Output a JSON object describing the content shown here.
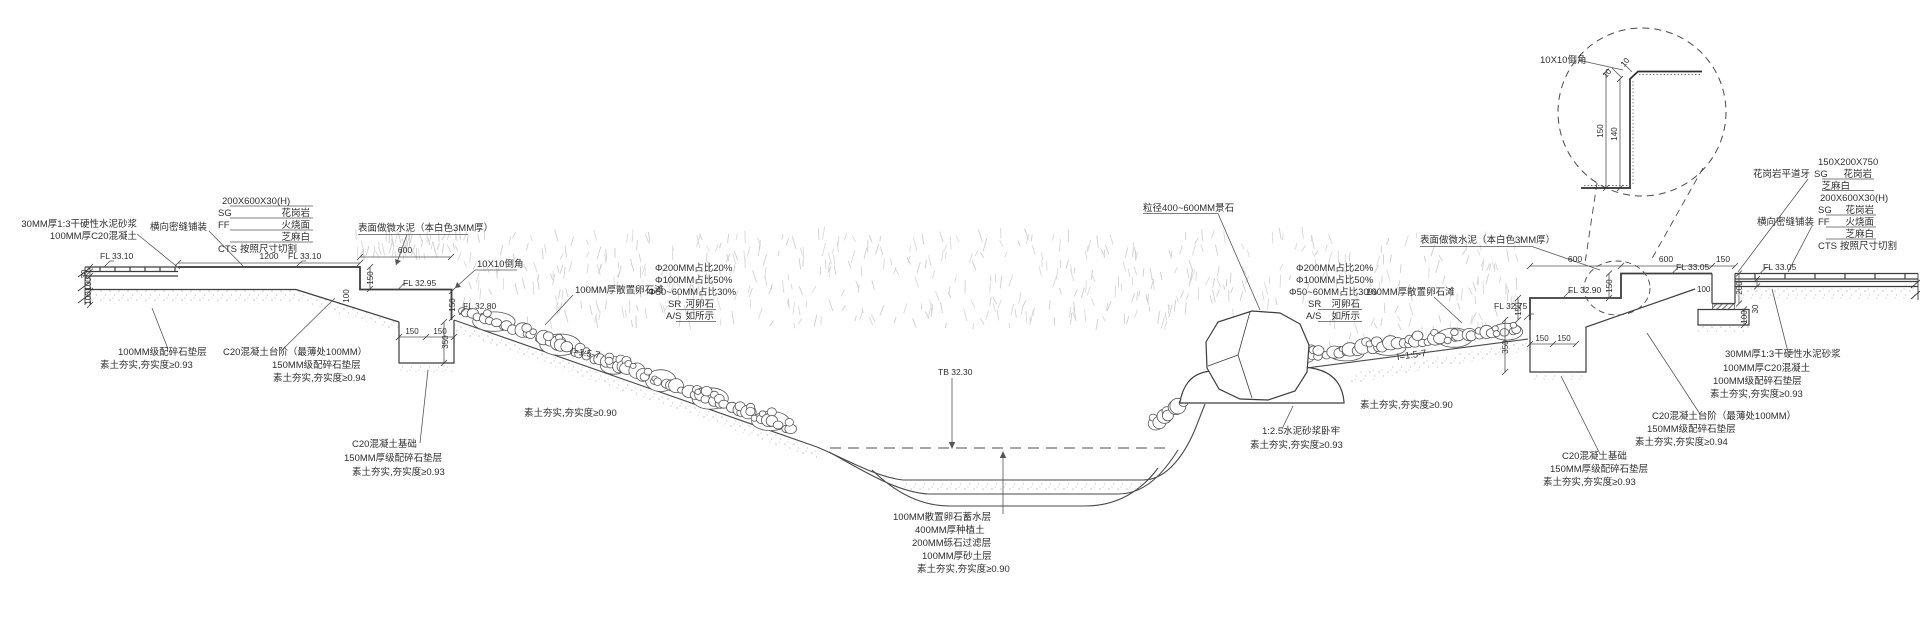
{
  "drawing": {
    "type": "landscape-dry-creek-section-detail",
    "colors": {
      "line": "#3d3d3d",
      "thin_line": "#555555",
      "text": "#2e2e2e",
      "grass": "#d8d8d8",
      "speckle": "#c2c2c2",
      "water_dash": "#a6a6a6"
    }
  },
  "annotations": [
    {
      "t": "30MM厚1:3干硬性水泥砂浆",
      "x": 137,
      "y": 227,
      "a": "e"
    },
    {
      "t": "100MM厚C20混凝土",
      "x": 137,
      "y": 239,
      "a": "e"
    },
    {
      "t": "横向密缝铺装",
      "x": 207,
      "y": 230,
      "a": "e"
    },
    {
      "t": "200X600X30(H)",
      "x": 222,
      "y": 204
    },
    {
      "t": "SG",
      "x": 218,
      "y": 216
    },
    {
      "t": "花岗岩",
      "x": 310,
      "y": 216,
      "a": "e"
    },
    {
      "t": "FF",
      "x": 218,
      "y": 228
    },
    {
      "t": "火烧面",
      "x": 310,
      "y": 228,
      "a": "e"
    },
    {
      "t": "芝麻白",
      "x": 310,
      "y": 240,
      "a": "e"
    },
    {
      "t": "CTS",
      "x": 218,
      "y": 252
    },
    {
      "t": "按照尺寸切割",
      "x": 240,
      "y": 252
    },
    {
      "t": "FL 33.10",
      "x": 100,
      "y": 259,
      "s": 8.5
    },
    {
      "t": "1200",
      "x": 269,
      "y": 259,
      "a": "m",
      "s": 8.5
    },
    {
      "t": "FL 33.10",
      "x": 288,
      "y": 259,
      "s": 8.5
    },
    {
      "t": "30",
      "x": 87,
      "y": 274,
      "r": -90,
      "a": "m",
      "s": 8
    },
    {
      "t": "100",
      "x": 91,
      "y": 284,
      "r": -90,
      "a": "m",
      "s": 8
    },
    {
      "t": "100",
      "x": 91,
      "y": 298,
      "r": -90,
      "a": "m",
      "s": 8
    },
    {
      "t": "100MM级配碎石垫层",
      "x": 118,
      "y": 355
    },
    {
      "t": "素土夯实,夯实度≥0.93",
      "x": 100,
      "y": 368
    },
    {
      "t": "C20混凝土台阶（最薄处100MM）",
      "x": 223,
      "y": 355
    },
    {
      "t": "150MM级配碎石垫层",
      "x": 272,
      "y": 368
    },
    {
      "t": "素土夯实,夯实度≥0.94",
      "x": 273,
      "y": 381
    },
    {
      "t": "表面做微水泥（本白色3MM厚）",
      "x": 358,
      "y": 231
    },
    {
      "t": "600",
      "x": 405,
      "y": 253,
      "a": "m",
      "s": 8.5
    },
    {
      "t": "FL 32.95",
      "x": 403,
      "y": 286,
      "s": 8.5
    },
    {
      "t": "150",
      "x": 373,
      "y": 278,
      "r": -90,
      "a": "m",
      "s": 8
    },
    {
      "t": "100",
      "x": 349,
      "y": 296,
      "r": -90,
      "a": "m",
      "s": 8
    },
    {
      "t": "10X10倒角",
      "x": 477,
      "y": 267
    },
    {
      "t": "150",
      "x": 455,
      "y": 305,
      "r": -90,
      "a": "m",
      "s": 8
    },
    {
      "t": "FL 32.80",
      "x": 463,
      "y": 309,
      "s": 8.5
    },
    {
      "t": "150",
      "x": 412,
      "y": 334,
      "a": "m",
      "s": 8
    },
    {
      "t": "150",
      "x": 440,
      "y": 334,
      "a": "m",
      "s": 8
    },
    {
      "t": "350",
      "x": 448,
      "y": 342,
      "r": -90,
      "a": "m",
      "s": 8
    },
    {
      "t": "100MM厚散置卵石滩",
      "x": 575,
      "y": 293
    },
    {
      "t": "Φ200MM占比20%",
      "x": 655,
      "y": 271
    },
    {
      "t": "Φ100MM占比50%",
      "x": 655,
      "y": 283
    },
    {
      "t": "Φ50~60MM占比30%",
      "x": 648,
      "y": 295
    },
    {
      "t": "SR",
      "x": 668,
      "y": 307
    },
    {
      "t": "河卵石",
      "x": 714,
      "y": 307,
      "a": "e"
    },
    {
      "t": "A/S",
      "x": 666,
      "y": 319
    },
    {
      "t": "如所示",
      "x": 714,
      "y": 319,
      "a": "e"
    },
    {
      "t": "I=1:5-7",
      "x": 585,
      "y": 356,
      "r": 9,
      "a": "m"
    },
    {
      "t": "素土夯实,夯实度≥0.90",
      "x": 524,
      "y": 416
    },
    {
      "t": "C20混凝土基础",
      "x": 352,
      "y": 447
    },
    {
      "t": "150MM厚级配碎石垫层",
      "x": 344,
      "y": 461
    },
    {
      "t": "素土夯实,夯实度≥0.93",
      "x": 352,
      "y": 475
    },
    {
      "t": "粒径400~600MM景石",
      "x": 1143,
      "y": 211
    },
    {
      "t": "TB 32.30",
      "x": 938,
      "y": 375,
      "s": 8.5
    },
    {
      "t": "100MM散置卵石蓄水层",
      "x": 893,
      "y": 520
    },
    {
      "t": "400MM厚种植土",
      "x": 915,
      "y": 533
    },
    {
      "t": "200MM砾石过滤层",
      "x": 912,
      "y": 546
    },
    {
      "t": "100MM厚砂土层",
      "x": 922,
      "y": 559
    },
    {
      "t": "素土夯实,夯实度≥0.90",
      "x": 917,
      "y": 572
    },
    {
      "t": "1:2.5水泥砂浆卧牢",
      "x": 1262,
      "y": 434
    },
    {
      "t": "素土夯实,夯实度≥0.93",
      "x": 1250,
      "y": 448
    },
    {
      "t": "I=1:5-7",
      "x": 1412,
      "y": 358,
      "r": -8,
      "a": "m"
    },
    {
      "t": "素土夯实,夯实度≥0.90",
      "x": 1360,
      "y": 408
    },
    {
      "t": "表面做微水泥（本白色3MM厚）",
      "x": 1420,
      "y": 243
    },
    {
      "t": "Φ200MM占比20%",
      "x": 1296,
      "y": 271
    },
    {
      "t": "Φ100MM占比50%",
      "x": 1296,
      "y": 283
    },
    {
      "t": "Φ50~60MM占比30%",
      "x": 1289,
      "y": 295
    },
    {
      "t": "SR",
      "x": 1308,
      "y": 307
    },
    {
      "t": "河卵石",
      "x": 1360,
      "y": 307,
      "a": "e"
    },
    {
      "t": "A/S",
      "x": 1306,
      "y": 319
    },
    {
      "t": "如所示",
      "x": 1360,
      "y": 319,
      "a": "e"
    },
    {
      "t": "100MM厚散置卵石滩",
      "x": 1366,
      "y": 295
    },
    {
      "t": "FL 32.75",
      "x": 1494,
      "y": 309,
      "s": 8.5
    },
    {
      "t": "150",
      "x": 1521,
      "y": 309,
      "r": -90,
      "a": "m",
      "s": 8
    },
    {
      "t": "FL 32.90",
      "x": 1568,
      "y": 293,
      "s": 8.5
    },
    {
      "t": "600",
      "x": 1575,
      "y": 262,
      "a": "m",
      "s": 8.5
    },
    {
      "t": "150",
      "x": 1612,
      "y": 286,
      "r": -90,
      "a": "m",
      "s": 8
    },
    {
      "t": "600",
      "x": 1666,
      "y": 262,
      "a": "m",
      "s": 8.5
    },
    {
      "t": "FL 33.05",
      "x": 1676,
      "y": 270,
      "s": 8.5
    },
    {
      "t": "150",
      "x": 1723,
      "y": 262,
      "a": "m",
      "s": 8.5
    },
    {
      "t": "100",
      "x": 1697,
      "y": 292,
      "s": 8
    },
    {
      "t": "FL 33.05",
      "x": 1763,
      "y": 270,
      "s": 8.5
    },
    {
      "t": "200",
      "x": 1742,
      "y": 288,
      "r": -90,
      "a": "m",
      "s": 8
    },
    {
      "t": "100",
      "x": 1747,
      "y": 317,
      "r": -90,
      "a": "m",
      "s": 8
    },
    {
      "t": "30",
      "x": 1758,
      "y": 309,
      "r": -90,
      "a": "m",
      "s": 8
    },
    {
      "t": "350",
      "x": 1508,
      "y": 347,
      "r": -90,
      "a": "m",
      "s": 8
    },
    {
      "t": "150",
      "x": 1542,
      "y": 341,
      "a": "m",
      "s": 8
    },
    {
      "t": "150",
      "x": 1564,
      "y": 341,
      "a": "m",
      "s": 8
    },
    {
      "t": "150X200X750",
      "x": 1818,
      "y": 165
    },
    {
      "t": "花岗岩平道牙",
      "x": 1810,
      "y": 177,
      "a": "e"
    },
    {
      "t": "SG",
      "x": 1814,
      "y": 177
    },
    {
      "t": "花岗岩",
      "x": 1872,
      "y": 177,
      "a": "e"
    },
    {
      "t": "芝麻白",
      "x": 1850,
      "y": 189,
      "a": "e"
    },
    {
      "t": "200X600X30(H)",
      "x": 1820,
      "y": 201
    },
    {
      "t": "SG",
      "x": 1818,
      "y": 213
    },
    {
      "t": "花岗岩",
      "x": 1874,
      "y": 213,
      "a": "e"
    },
    {
      "t": "横向密缝铺装",
      "x": 1814,
      "y": 225,
      "a": "e"
    },
    {
      "t": "FF",
      "x": 1818,
      "y": 225
    },
    {
      "t": "火烧面",
      "x": 1874,
      "y": 225,
      "a": "e"
    },
    {
      "t": "芝麻白",
      "x": 1874,
      "y": 237,
      "a": "e"
    },
    {
      "t": "CTS",
      "x": 1818,
      "y": 249
    },
    {
      "t": "按照尺寸切割",
      "x": 1840,
      "y": 249
    },
    {
      "t": "30MM厚1:3干硬性水泥砂浆",
      "x": 1725,
      "y": 357
    },
    {
      "t": "100MM厚C20混凝土",
      "x": 1723,
      "y": 371
    },
    {
      "t": "100MM级配碎石垫层",
      "x": 1713,
      "y": 384
    },
    {
      "t": "素土夯实,夯实度≥0.93",
      "x": 1710,
      "y": 397
    },
    {
      "t": "C20混凝土台阶（最薄处100MM）",
      "x": 1652,
      "y": 419
    },
    {
      "t": "150MM级配碎石垫层",
      "x": 1647,
      "y": 432
    },
    {
      "t": "素土夯实,夯实度≥0.94",
      "x": 1635,
      "y": 445
    },
    {
      "t": "C20混凝土基础",
      "x": 1562,
      "y": 459
    },
    {
      "t": "150MM厚级配碎石垫层",
      "x": 1550,
      "y": 472
    },
    {
      "t": "素土夯实,夯实度≥0.93",
      "x": 1543,
      "y": 485
    },
    {
      "t": "10X10倒角",
      "x": 1540,
      "y": 63
    },
    {
      "t": "10",
      "x": 1627,
      "y": 64,
      "r": -50,
      "a": "m",
      "s": 8
    },
    {
      "t": "10",
      "x": 1609,
      "y": 75,
      "r": -50,
      "a": "m",
      "s": 8
    },
    {
      "t": "150",
      "x": 1603,
      "y": 131,
      "r": -90,
      "a": "m",
      "s": 8
    },
    {
      "t": "140",
      "x": 1617,
      "y": 134,
      "r": -90,
      "a": "m",
      "s": 8
    }
  ]
}
